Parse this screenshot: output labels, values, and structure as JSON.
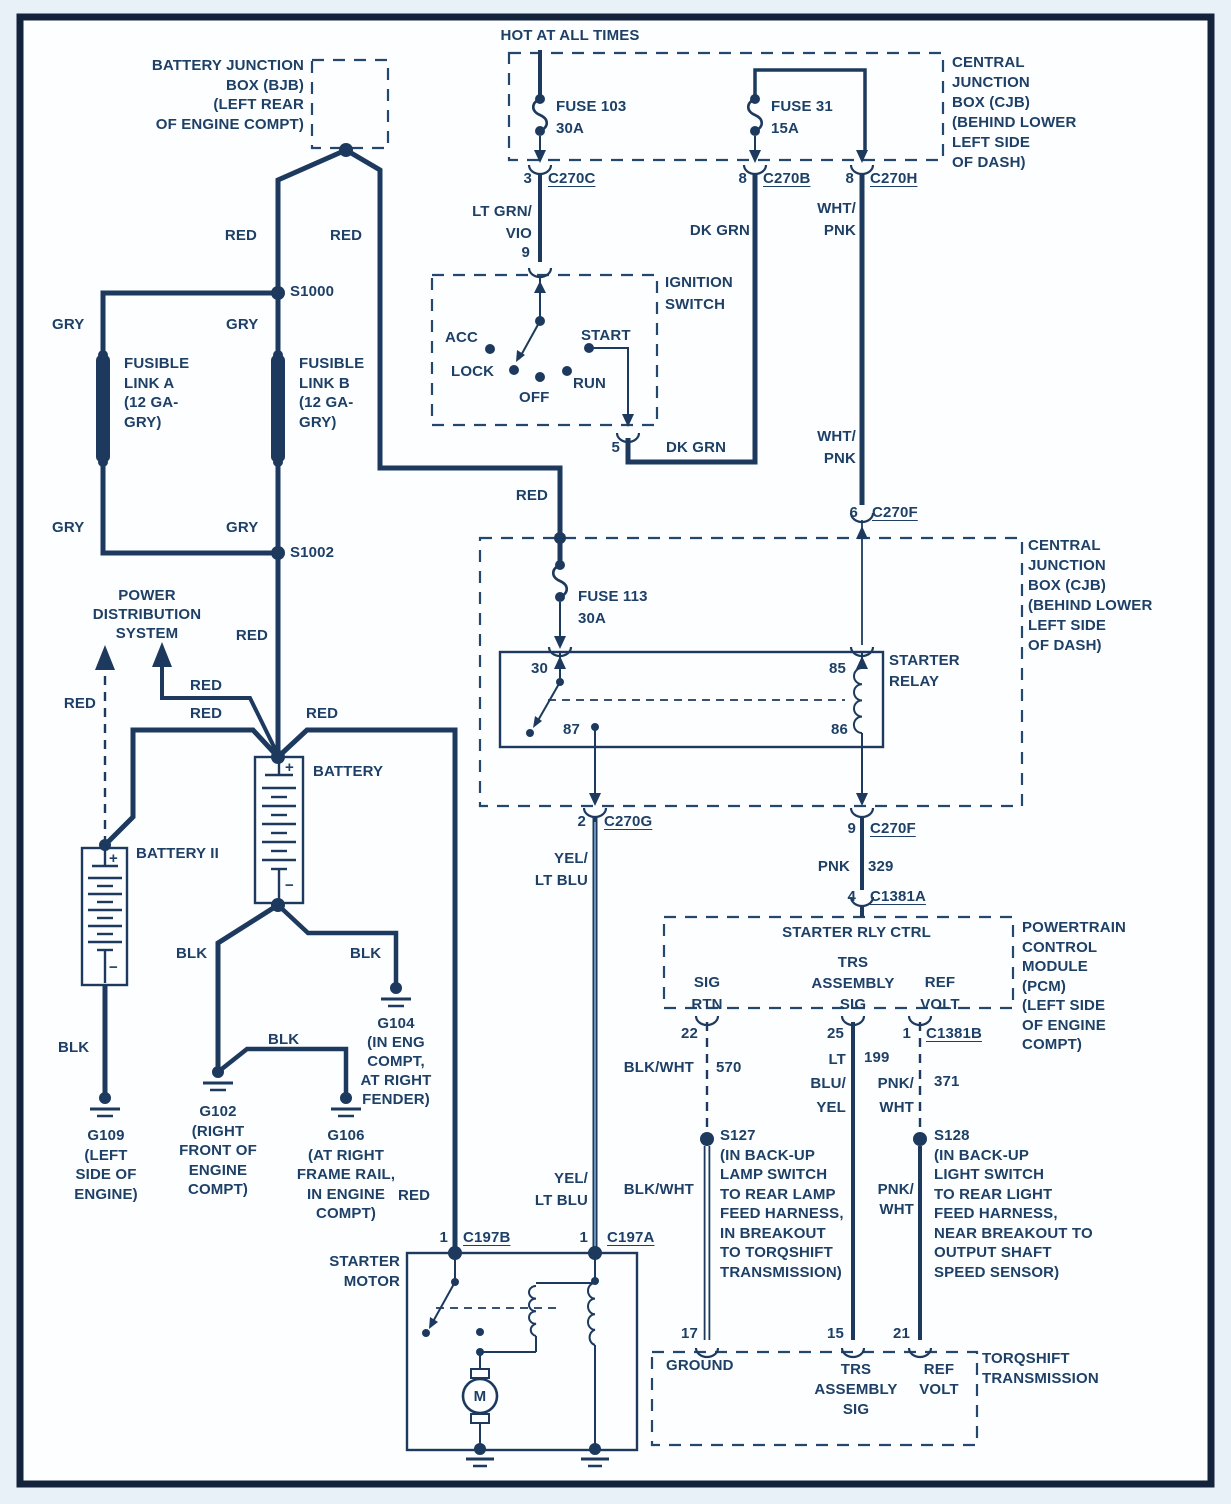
{
  "colors": {
    "ink": "#1e4066",
    "wire": "#1d3a5e",
    "frame": "#14233c",
    "background": "#fcfeff",
    "margin": "#e8f1f7",
    "wire_core_light": "#7fa8cc"
  },
  "header": {
    "hot_at_all_times": "HOT AT ALL TIMES"
  },
  "wire_colors": {
    "red": "RED",
    "gry": "GRY",
    "blk": "BLK",
    "dk_grn": "DK GRN",
    "wht_pnk": "WHT/\nPNK",
    "lt_grn_vio": "LT GRN/\nVIO",
    "yel_lt_blu": "YEL/\nLT BLU",
    "blk_wht": "BLK/WHT",
    "pnk_wht": "PNK/\nWHT",
    "lt_blu_yel": "LT\nBLU/\nYEL",
    "pnk": "PNK"
  },
  "circuits": {
    "c570": "570",
    "c199": "199",
    "c371": "371",
    "c329": "329"
  },
  "fuses": {
    "f103": "FUSE 103\n30A",
    "f31": "FUSE 31\n15A",
    "f113": "FUSE 113\n30A"
  },
  "links": {
    "a": "FUSIBLE\nLINK A\n(12 GA-\nGRY)",
    "b": "FUSIBLE\nLINK B\n(12 GA-\nGRY)"
  },
  "boxes": {
    "bjb": {
      "label": "BATTERY JUNCTION\nBOX (BJB)\n(LEFT REAR\nOF ENGINE COMPT)"
    },
    "cjb": {
      "label": "CENTRAL\nJUNCTION\nBOX (CJB)\n(BEHIND LOWER\nLEFT SIDE\nOF DASH)"
    },
    "ignition": {
      "label": "IGNITION\nSWITCH",
      "acc": "ACC",
      "lock": "LOCK",
      "off": "OFF",
      "run": "RUN",
      "start": "START",
      "pin_in": "9",
      "pin_out": "5"
    },
    "relay": {
      "label": "STARTER\nRELAY",
      "p30": "30",
      "p85": "85",
      "p87": "87",
      "p86": "86"
    },
    "pcm": {
      "label": "POWERTRAIN\nCONTROL\nMODULE\n(PCM)\n(LEFT SIDE\nOF ENGINE\nCOMPT)",
      "ctrl": "STARTER RLY CTRL",
      "sig_rtn": "SIG\nRTN",
      "trs": "TRS\nASSEMBLY\nSIG",
      "ref": "REF\nVOLT",
      "p22": "22",
      "p25": "25",
      "p1": "1"
    },
    "trans": {
      "label": "TORQSHIFT\nTRANSMISSION",
      "ground": "GROUND",
      "p17": "17",
      "p15": "15",
      "p21": "21"
    },
    "starter": {
      "label": "STARTER\nMOTOR",
      "motor": "M"
    }
  },
  "power": {
    "pds": "POWER\nDISTRIBUTION\nSYSTEM",
    "battery": "BATTERY",
    "battery2": "BATTERY II",
    "plus": "+",
    "minus": "−"
  },
  "splices": {
    "s1000": "S1000",
    "s1002": "S1002",
    "s127": "S127\n(IN BACK-UP\nLAMP SWITCH\nTO REAR LAMP\nFEED HARNESS,\nIN BREAKOUT\nTO TORQSHIFT\nTRANSMISSION)",
    "s128": "S128\n(IN BACK-UP\nLIGHT SWITCH\nTO REAR LIGHT\nFEED HARNESS,\nNEAR BREAKOUT TO\nOUTPUT SHAFT\nSPEED SENSOR)"
  },
  "grounds": {
    "g109": "G109\n(LEFT\nSIDE OF\nENGINE)",
    "g102": "G102\n(RIGHT\nFRONT OF\nENGINE\nCOMPT)",
    "g106": "G106\n(AT RIGHT\nFRAME RAIL,\nIN ENGINE\nCOMPT)",
    "g104": "G104\n(IN ENG\nCOMPT,\nAT RIGHT\nFENDER)"
  },
  "connectors": {
    "c270c": {
      "pin": "3",
      "name": "C270C"
    },
    "c270b": {
      "pin": "8",
      "name": "C270B"
    },
    "c270h": {
      "pin": "8",
      "name": "C270H"
    },
    "c270f6": {
      "pin": "6",
      "name": "C270F"
    },
    "c270g": {
      "pin": "2",
      "name": "C270G"
    },
    "c270f9": {
      "pin": "9",
      "name": "C270F"
    },
    "c1381a": {
      "pin": "4",
      "name": "C1381A"
    },
    "c1381b": {
      "pin": "1",
      "name": "C1381B"
    },
    "c197b": {
      "pin": "1",
      "name": "C197B"
    },
    "c197a": {
      "pin": "1",
      "name": "C197A"
    }
  }
}
